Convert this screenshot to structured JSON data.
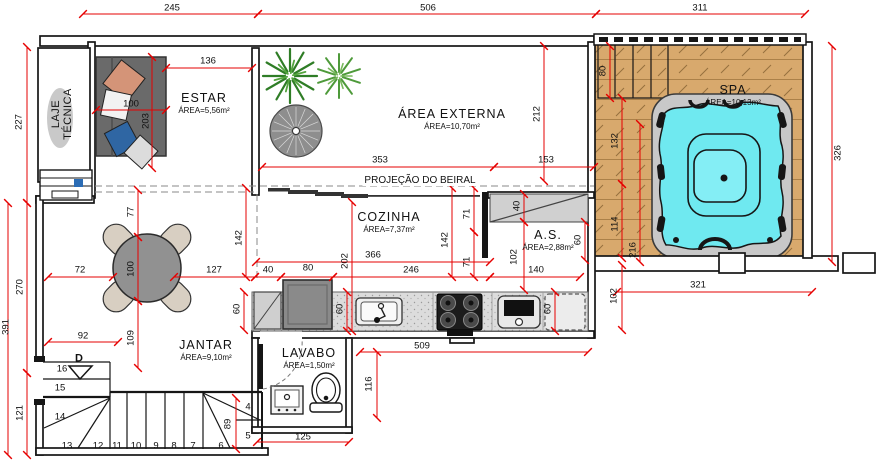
{
  "colors": {
    "wall": "#161616",
    "dim_red": "#e60000",
    "deck_wood": "#d8a96d",
    "deck_grain": "#96703d",
    "spa_water": "#6fe9f0",
    "tub_shell": "#c8c8c8",
    "sofa_gray": "#6a6a6a",
    "pillow_salmon": "#d49478",
    "pillow_blue": "#2f66a3",
    "table_gray": "#919191",
    "chair_beige": "#d8cfc2",
    "plant_green": "#2f7d26",
    "counter_gray": "#dcdcdc",
    "beiral_gray": "#8a8a8a"
  },
  "rooms": {
    "laje": {
      "name": "LAJE TÉCNICA",
      "area": "",
      "x": 62,
      "y": 114
    },
    "estar": {
      "name": "ESTAR",
      "area": "ÁREA=5,56m²",
      "x": 204,
      "y": 103
    },
    "externa": {
      "name": "ÁREA EXTERNA",
      "area": "ÁREA=10,70m²",
      "x": 452,
      "y": 119
    },
    "spa": {
      "name": "SPA",
      "area": "ÁREA=10,13m²",
      "x": 733,
      "y": 95
    },
    "cozinha": {
      "name": "COZINHA",
      "area": "ÁREA=7,37m²",
      "x": 389,
      "y": 222
    },
    "as": {
      "name": "A.S.",
      "area": "ÁREA=2,88m²",
      "x": 548,
      "y": 240
    },
    "jantar": {
      "name": "JANTAR",
      "area": "ÁREA=9,10m²",
      "x": 206,
      "y": 350
    },
    "lavabo": {
      "name": "LAVABO",
      "area": "ÁREA=1,50m²",
      "x": 309,
      "y": 358
    }
  },
  "notes": [
    {
      "t": "PROJEÇÃO DO BEIRAL",
      "x": 420,
      "y": 181,
      "cls": "note"
    },
    {
      "t": "D",
      "x": 79,
      "y": 359,
      "cls": "note d"
    }
  ],
  "dims": [
    {
      "v": "245",
      "x": 172,
      "y": 8
    },
    {
      "v": "506",
      "x": 428,
      "y": 8
    },
    {
      "v": "311",
      "x": 700,
      "y": 8
    },
    {
      "v": "227",
      "x": 19,
      "y": 122,
      "r": 1
    },
    {
      "v": "270",
      "x": 20,
      "y": 287,
      "r": 1
    },
    {
      "v": "391",
      "x": 6,
      "y": 327,
      "r": 1
    },
    {
      "v": "121",
      "x": 20,
      "y": 413,
      "r": 1
    },
    {
      "v": "326",
      "x": 838,
      "y": 153,
      "r": 1
    },
    {
      "v": "136",
      "x": 208,
      "y": 61
    },
    {
      "v": "100",
      "x": 131,
      "y": 104
    },
    {
      "v": "203",
      "x": 146,
      "y": 121,
      "r": 1
    },
    {
      "v": "353",
      "x": 380,
      "y": 160
    },
    {
      "v": "153",
      "x": 546,
      "y": 160
    },
    {
      "v": "212",
      "x": 537,
      "y": 114,
      "r": 1
    },
    {
      "v": "80",
      "x": 603,
      "y": 71,
      "r": 1
    },
    {
      "v": "132",
      "x": 615,
      "y": 141,
      "r": 1
    },
    {
      "v": "114",
      "x": 615,
      "y": 224,
      "r": 1
    },
    {
      "v": "216",
      "x": 633,
      "y": 250,
      "r": 1
    },
    {
      "v": "102",
      "x": 614,
      "y": 296,
      "r": 1
    },
    {
      "v": "321",
      "x": 698,
      "y": 285
    },
    {
      "v": "366",
      "x": 373,
      "y": 255
    },
    {
      "v": "246",
      "x": 411,
      "y": 270
    },
    {
      "v": "140",
      "x": 536,
      "y": 270
    },
    {
      "v": "80",
      "x": 308,
      "y": 268
    },
    {
      "v": "40",
      "x": 268,
      "y": 270
    },
    {
      "v": "72",
      "x": 80,
      "y": 270
    },
    {
      "v": "127",
      "x": 214,
      "y": 270
    },
    {
      "v": "142",
      "x": 445,
      "y": 240,
      "r": 1
    },
    {
      "v": "71",
      "x": 467,
      "y": 214,
      "r": 1
    },
    {
      "v": "71",
      "x": 467,
      "y": 262,
      "r": 1
    },
    {
      "v": "202",
      "x": 345,
      "y": 261,
      "r": 1
    },
    {
      "v": "142",
      "x": 239,
      "y": 238,
      "r": 1
    },
    {
      "v": "77",
      "x": 131,
      "y": 212,
      "r": 1
    },
    {
      "v": "100",
      "x": 131,
      "y": 269,
      "r": 1
    },
    {
      "v": "109",
      "x": 131,
      "y": 338,
      "r": 1
    },
    {
      "v": "92",
      "x": 83,
      "y": 336
    },
    {
      "v": "60",
      "x": 237,
      "y": 309,
      "r": 1
    },
    {
      "v": "60",
      "x": 340,
      "y": 309,
      "r": 1
    },
    {
      "v": "60",
      "x": 548,
      "y": 309,
      "r": 1
    },
    {
      "v": "60",
      "x": 578,
      "y": 240,
      "r": 1
    },
    {
      "v": "40",
      "x": 517,
      "y": 206,
      "r": 1
    },
    {
      "v": "102",
      "x": 514,
      "y": 257,
      "r": 1
    },
    {
      "v": "89",
      "x": 228,
      "y": 424,
      "r": 1
    },
    {
      "v": "509",
      "x": 422,
      "y": 346
    },
    {
      "v": "116",
      "x": 369,
      "y": 384,
      "r": 1
    },
    {
      "v": "125",
      "x": 303,
      "y": 437
    }
  ],
  "steps": [
    {
      "n": "4",
      "x": 248,
      "y": 407
    },
    {
      "n": "5",
      "x": 248,
      "y": 436
    },
    {
      "n": "6",
      "x": 221,
      "y": 446
    },
    {
      "n": "7",
      "x": 193,
      "y": 446
    },
    {
      "n": "8",
      "x": 174,
      "y": 446
    },
    {
      "n": "9",
      "x": 156,
      "y": 446
    },
    {
      "n": "10",
      "x": 136,
      "y": 446
    },
    {
      "n": "11",
      "x": 117,
      "y": 446
    },
    {
      "n": "12",
      "x": 98,
      "y": 446
    },
    {
      "n": "13",
      "x": 67,
      "y": 446
    },
    {
      "n": "14",
      "x": 60,
      "y": 417
    },
    {
      "n": "15",
      "x": 60,
      "y": 388
    },
    {
      "n": "16",
      "x": 62,
      "y": 369
    }
  ]
}
